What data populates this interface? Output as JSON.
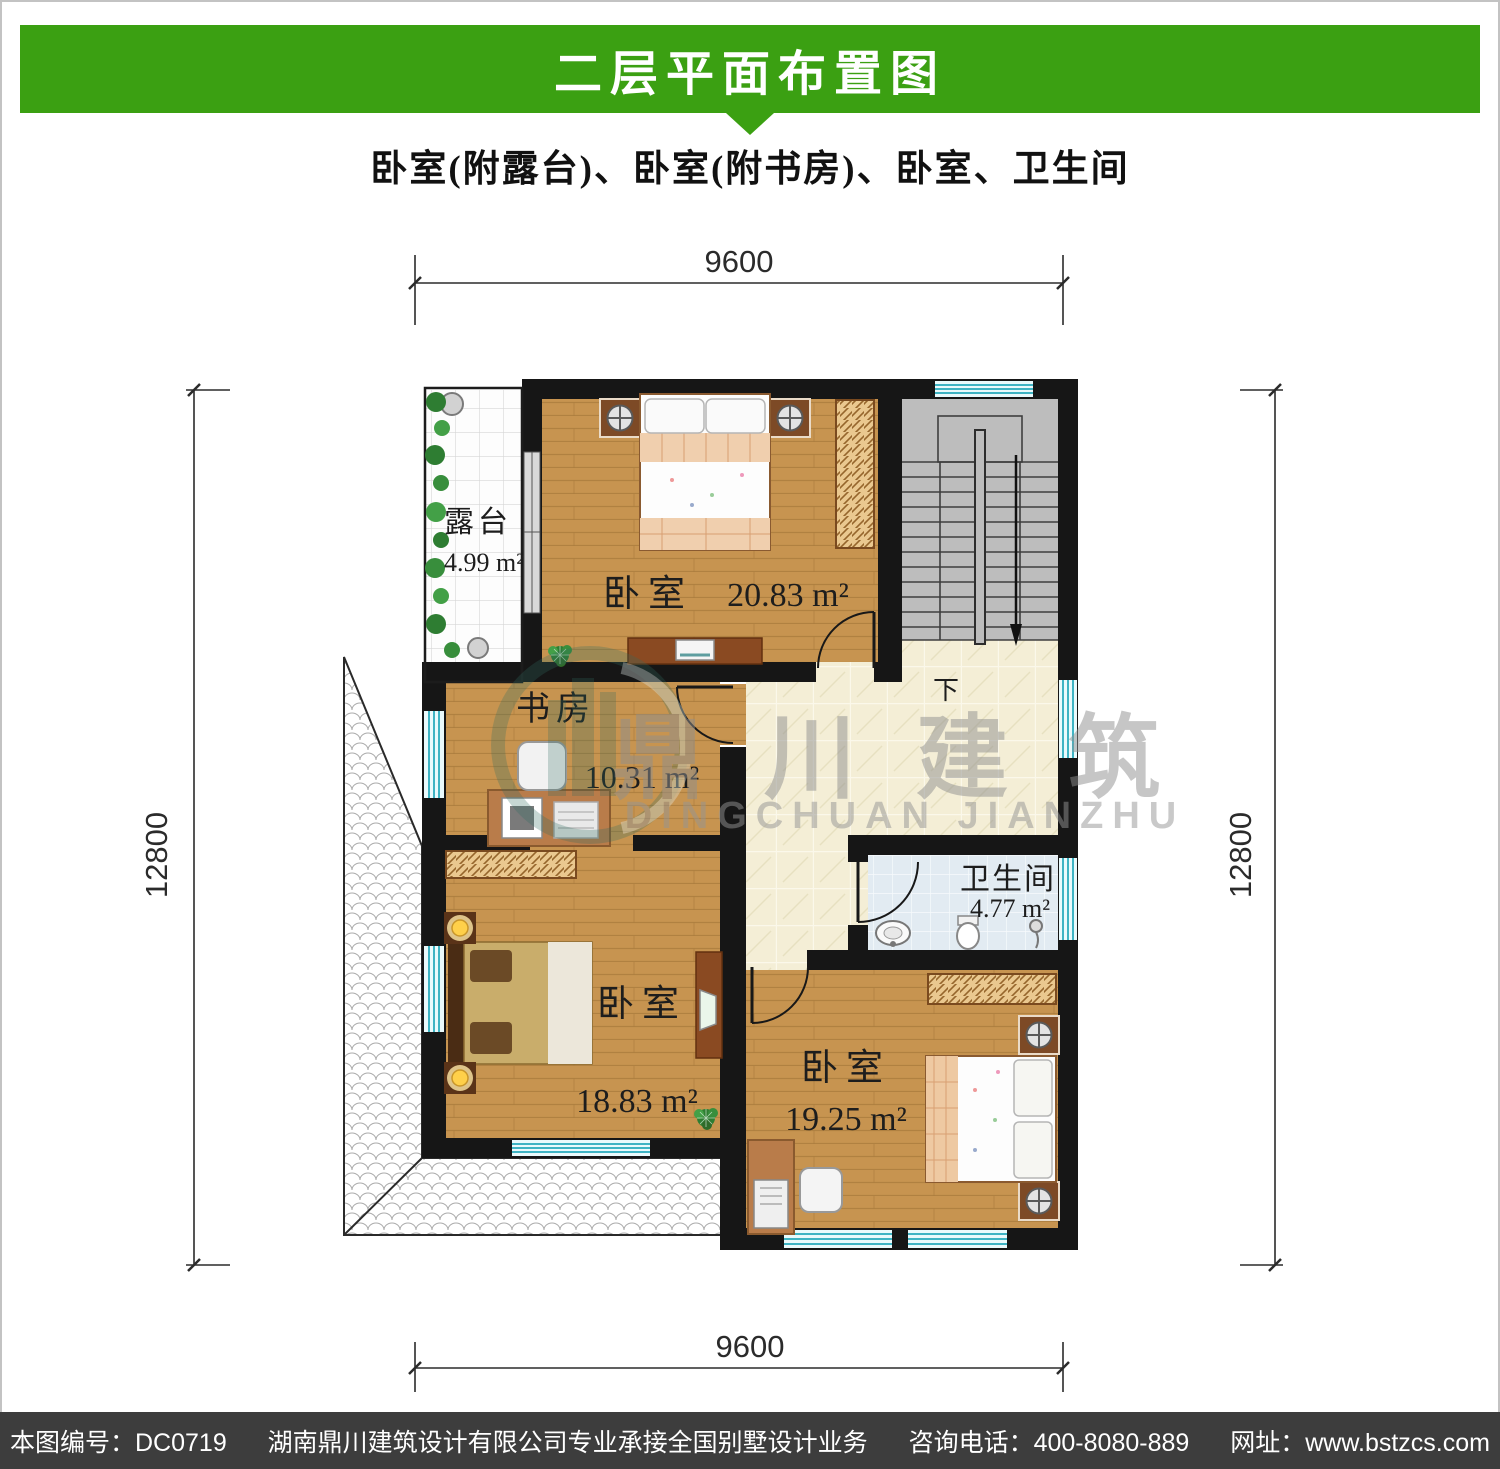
{
  "header": {
    "title": "二层平面布置图"
  },
  "subtitle": "卧室(附露台)、卧室(附书房)、卧室、卫生间",
  "dimensions": {
    "top": "9600",
    "bottom": "9600",
    "left": "12800",
    "right": "12800"
  },
  "rooms": {
    "terrace": {
      "name": "露台",
      "area": "4.99 m²"
    },
    "bedroom_top": {
      "name": "卧室",
      "area": "20.83 m²"
    },
    "study": {
      "name": "书房",
      "area": "10.31 m²"
    },
    "bathroom": {
      "name": "卫生间",
      "area": "4.77 m²"
    },
    "bedroom_left": {
      "name": "卧室",
      "area": "18.83 m²"
    },
    "bedroom_right": {
      "name": "卧室",
      "area": "19.25 m²"
    }
  },
  "stairs": {
    "direction_label": "下"
  },
  "watermark": {
    "name_cn": "鼎川建筑",
    "name_en": "DINGCHUAN JIANZHU"
  },
  "footer": {
    "plan_number": "本图编号：DC0719",
    "company": "湖南鼎川建筑设计有限公司专业承接全国别墅设计业务",
    "phone": "咨询电话：400-8080-889",
    "website": "网址：www.bstzcs.com"
  },
  "colors": {
    "accent_green": "#3ba012",
    "footer_bg": "#3d3d3d",
    "wall": "#161616",
    "window_stripe": "#3fb4c4"
  }
}
